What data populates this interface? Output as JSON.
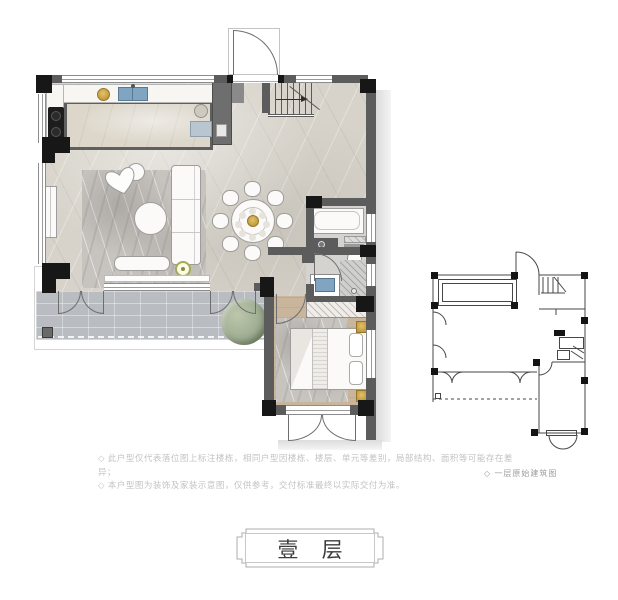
{
  "plaque": {
    "label": "壹 层"
  },
  "notes": {
    "line1": "◇ 此户型仅代表落位图上标注楼栋，相同户型因楼栋、楼层、单元等差别，局部结构、面积等可能存在差异；",
    "line2": "◇ 本户型图为装饰及家装示意图，仅供参考，交付标准最终以实际交付为准。"
  },
  "mini_diagram": {
    "caption": "◇ 一层原始建筑图"
  },
  "colors": {
    "wall": "#5c5c5c",
    "column": "#171717",
    "line": "#6e6e6e",
    "floor-main": "#d7d3ca",
    "floor-island": "#ddd7cb",
    "floor-bath": "#d4d3d0",
    "floor-bedroom": "#c9b49c",
    "floor-terrace": "#b9bdc1",
    "rug": "#c7c4c0",
    "accent-blue": "#7fa5c2",
    "accent-gold": "#c29b3d",
    "plant-green": "#9fae92",
    "shadow": "#dcdcdc",
    "text-note": "#c3c3c3",
    "text-caption": "#9c9c9c",
    "text-title": "#3d3d3d"
  }
}
